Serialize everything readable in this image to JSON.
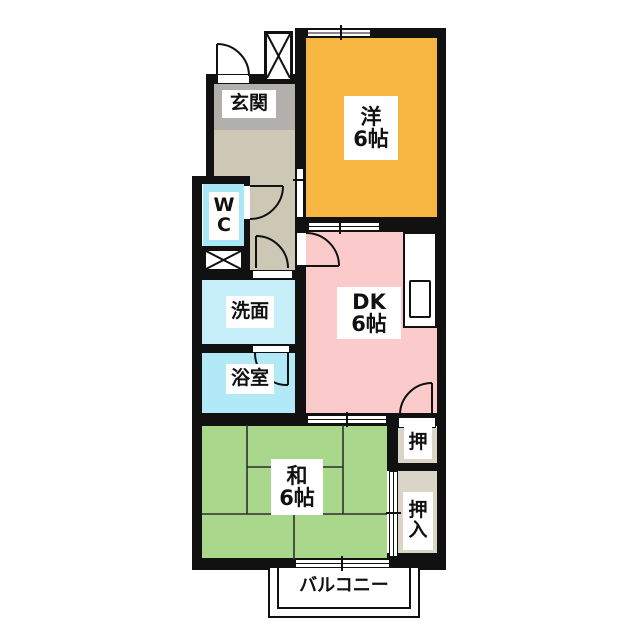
{
  "plan_title": "apartment-floor-plan",
  "colors": {
    "wall": "#111111",
    "background": "#ffffff",
    "genkan": "#b2b0ad",
    "hallway": "#cdc7b6",
    "western_room": "#f7b541",
    "dk": "#fbcbcb",
    "japanese_room": "#a9d88c",
    "wc": "#a9e7f7",
    "washroom": "#c6effa",
    "bathroom": "#b2e9f6",
    "closet": "#d9d6c8",
    "label_bg": "#ffffff"
  },
  "rooms": {
    "genkan": {
      "label": "玄関"
    },
    "western": {
      "line1": "洋",
      "line2": "6帖"
    },
    "wc": {
      "line1": "W",
      "line2": "C"
    },
    "washroom": {
      "label": "洗面"
    },
    "bathroom": {
      "label": "浴室"
    },
    "dk": {
      "line1": "DK",
      "line2": "6帖"
    },
    "japanese": {
      "line1": "和",
      "line2": "6帖"
    },
    "closet_upper": {
      "label": "押"
    },
    "closet_lower": {
      "line1": "押",
      "line2": "入"
    },
    "balcony": {
      "label": "バルコニー"
    }
  }
}
